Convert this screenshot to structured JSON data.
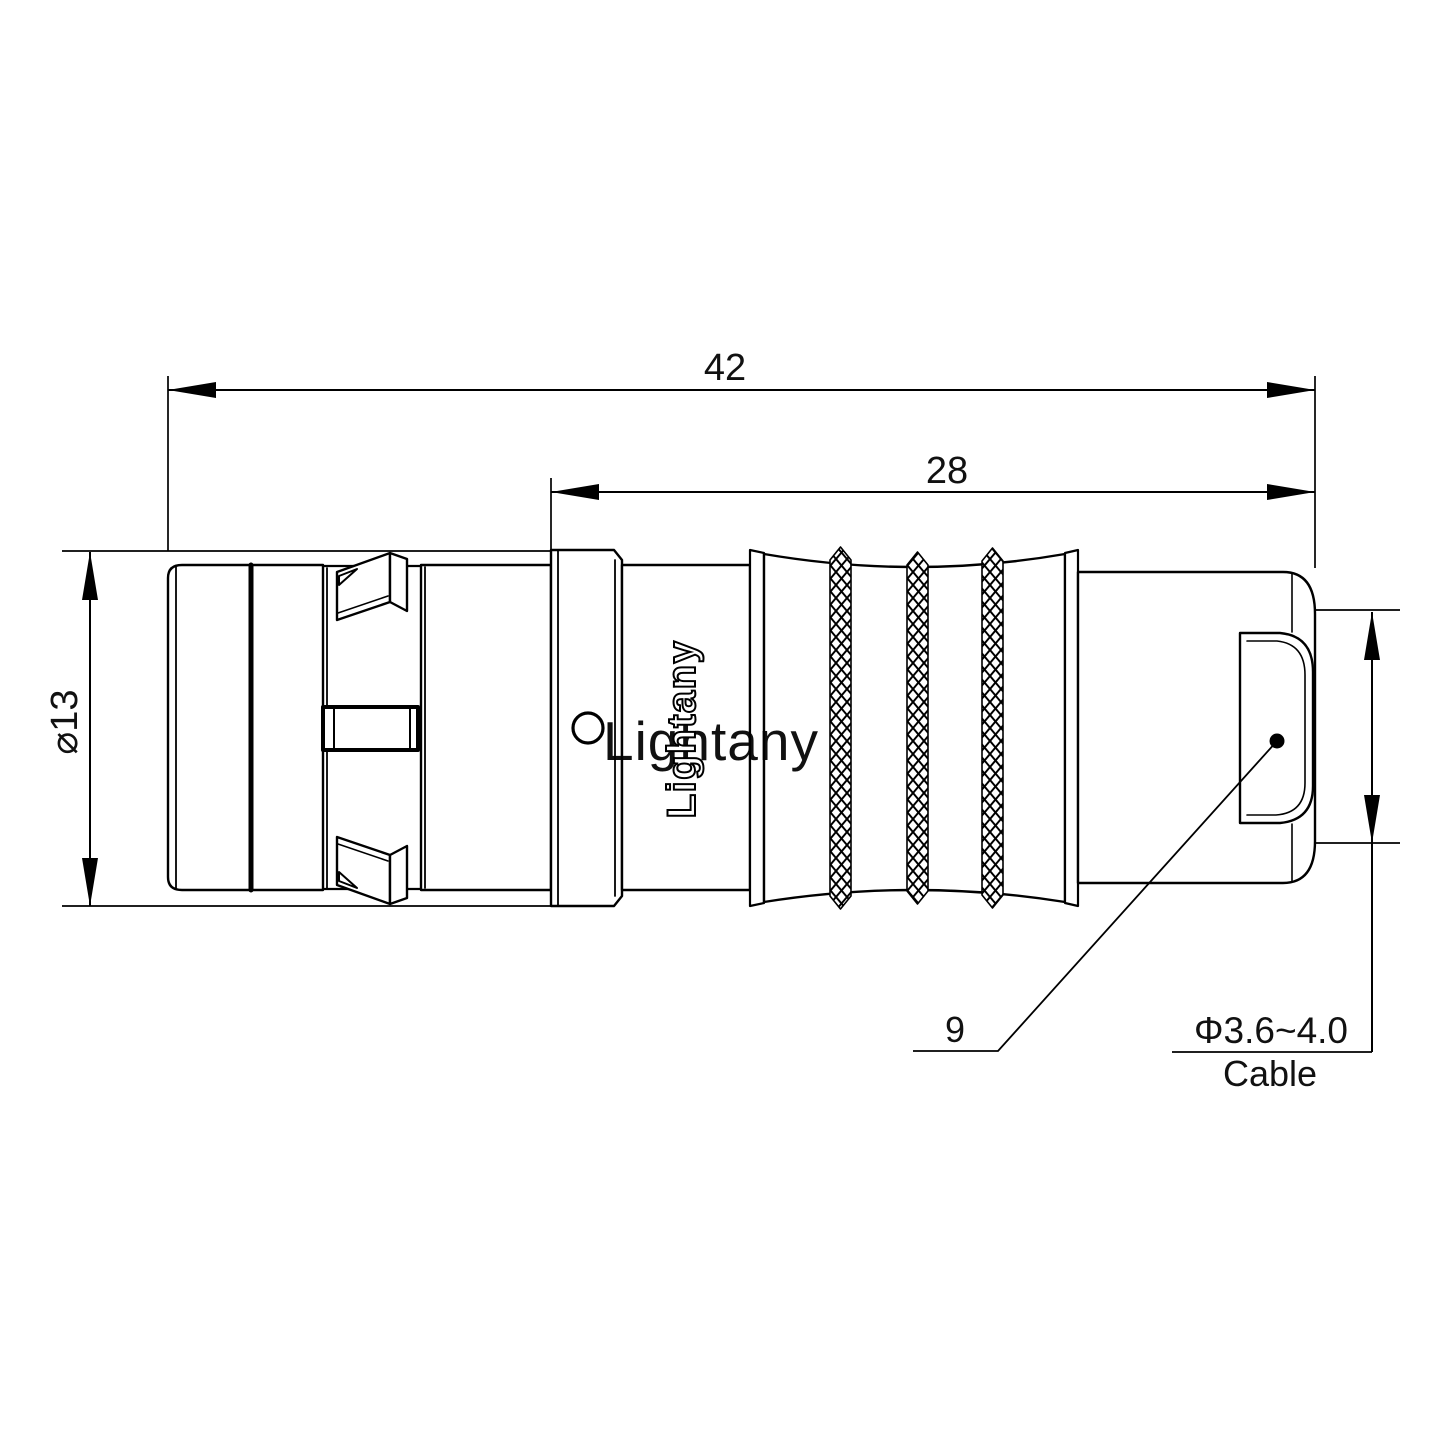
{
  "drawing": {
    "description": "Technical side-view drawing of a push-pull circular cable connector with knurled grip and dimension callouts",
    "line_color": "#000000",
    "background_color": "#ffffff"
  },
  "dimensions": {
    "overall_length": "42",
    "rear_section_length": "28",
    "shell_diameter": "⌀13",
    "size_label": "9",
    "cable_diameter": "Φ3.6~4.0",
    "cable_label": "Cable"
  },
  "branding": {
    "logo_text": "Lightany",
    "watermark_text": "Lightany",
    "watermark_color": "#efb4b4"
  }
}
